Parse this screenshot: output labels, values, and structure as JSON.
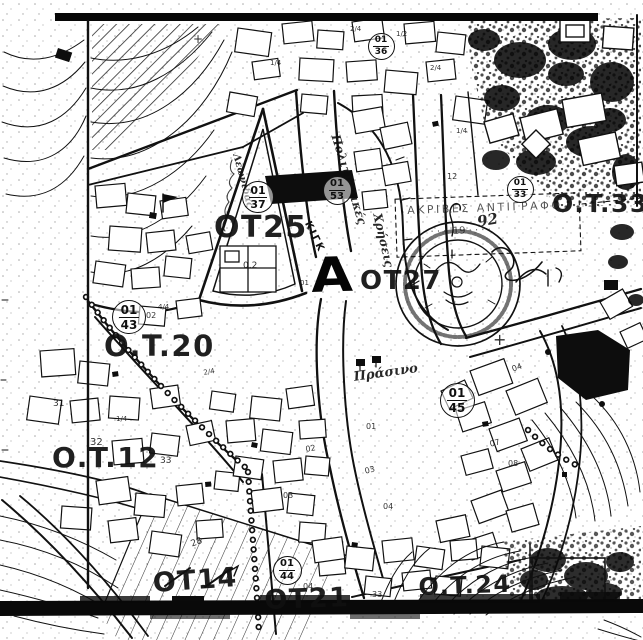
{
  "colors": {
    "ink": "#141414",
    "paper": "#ffffff"
  },
  "marker": {
    "text": "A"
  },
  "labels": {
    "blocks": [
      {
        "text": "OT25",
        "x": 214,
        "y": 213,
        "size": 30,
        "rot": 0
      },
      {
        "text": "O.T.33",
        "x": 552,
        "y": 191,
        "size": 25,
        "rot": 0
      },
      {
        "text": "OT27",
        "x": 360,
        "y": 268,
        "size": 26,
        "rot": 0
      },
      {
        "text": "O.T.20",
        "x": 104,
        "y": 332,
        "size": 29,
        "rot": 0
      },
      {
        "text": "O.T.12",
        "x": 52,
        "y": 444,
        "size": 28,
        "rot": 0
      },
      {
        "text": "OT14",
        "x": 152,
        "y": 570,
        "size": 27,
        "rot": -4
      },
      {
        "text": "OT21",
        "x": 264,
        "y": 587,
        "size": 27,
        "rot": -2
      },
      {
        "text": "O.T.24",
        "x": 418,
        "y": 575,
        "size": 24,
        "rot": -2
      }
    ],
    "circles": [
      {
        "top": "01",
        "bottom": "37",
        "cx": 257,
        "cy": 196,
        "d": 30
      },
      {
        "top": "01",
        "bottom": "53",
        "cx": 336,
        "cy": 189,
        "d": 27
      },
      {
        "top": "01",
        "bottom": "36",
        "cx": 380,
        "cy": 45,
        "d": 25
      },
      {
        "top": "01",
        "bottom": "33",
        "cx": 519,
        "cy": 188,
        "d": 25
      },
      {
        "top": "01",
        "bottom": "43",
        "cx": 128,
        "cy": 316,
        "d": 32
      },
      {
        "top": "01",
        "bottom": "44",
        "cx": 286,
        "cy": 569,
        "d": 27
      },
      {
        "top": "01",
        "bottom": "45",
        "cx": 456,
        "cy": 399,
        "d": 33
      }
    ],
    "notes": [
      {
        "text": "ΑΚΡΙΒΕΣ ΑΝΤΙΓΡΑΦΟ",
        "x": 407,
        "y": 205,
        "size": 11,
        "rot": -2,
        "ls": 2.5,
        "cls": "faded"
      },
      {
        "text": "· · · ·  19 · · · ·",
        "x": 424,
        "y": 228,
        "size": 10,
        "rot": -2,
        "cls": "faded"
      },
      {
        "text": "92",
        "x": 476,
        "y": 215,
        "size": 15,
        "rot": -10,
        "cls": "hand"
      },
      {
        "text": "Πολιτιστικές",
        "x": 341,
        "y": 133,
        "size": 12,
        "rot": 73,
        "cls": "hand"
      },
      {
        "text": "Χρήσεις",
        "x": 383,
        "y": 212,
        "size": 12,
        "rot": 77,
        "cls": "hand"
      },
      {
        "text": "ΚΙΓΚ",
        "x": 311,
        "y": 220,
        "size": 10,
        "rot": 64,
        "ls": 2
      },
      {
        "text": "Πράσινο",
        "x": 353,
        "y": 371,
        "size": 13,
        "rot": -8,
        "cls": "hand"
      },
      {
        "text": "Λεωνίδας",
        "x": 240,
        "y": 153,
        "size": 10,
        "rot": 75,
        "cls": "hand"
      }
    ],
    "tiny": [
      {
        "text": "0.2",
        "x": 243,
        "y": 262,
        "size": 9
      },
      {
        "text": "02",
        "x": 146,
        "y": 312,
        "size": 8
      },
      {
        "text": "32",
        "x": 90,
        "y": 438,
        "size": 10
      },
      {
        "text": "33",
        "x": 160,
        "y": 457,
        "size": 9
      },
      {
        "text": "31",
        "x": 53,
        "y": 400,
        "size": 9
      },
      {
        "text": "02",
        "x": 305,
        "y": 446,
        "size": 8,
        "rot": -10
      },
      {
        "text": "03",
        "x": 283,
        "y": 492,
        "size": 8
      },
      {
        "text": "03",
        "x": 364,
        "y": 468,
        "size": 8,
        "rot": -15
      },
      {
        "text": "04",
        "x": 383,
        "y": 503,
        "size": 8
      },
      {
        "text": "01",
        "x": 366,
        "y": 423,
        "size": 8
      },
      {
        "text": "28",
        "x": 190,
        "y": 541,
        "size": 9,
        "rot": -20
      },
      {
        "text": "04",
        "x": 303,
        "y": 583,
        "size": 8
      },
      {
        "text": "04",
        "x": 511,
        "y": 366,
        "size": 8,
        "rot": -20
      },
      {
        "text": "07",
        "x": 489,
        "y": 441,
        "size": 8,
        "rot": -15
      },
      {
        "text": "08",
        "x": 508,
        "y": 460,
        "size": 8
      },
      {
        "text": "12",
        "x": 447,
        "y": 173,
        "size": 8
      },
      {
        "text": "1/4",
        "x": 456,
        "y": 128,
        "size": 7
      },
      {
        "text": "2/4",
        "x": 350,
        "y": 26,
        "size": 7
      },
      {
        "text": "1/2",
        "x": 396,
        "y": 31,
        "size": 7
      },
      {
        "text": "1/4",
        "x": 116,
        "y": 416,
        "size": 7
      },
      {
        "text": "4/4",
        "x": 158,
        "y": 304,
        "size": 7
      },
      {
        "text": "2/4",
        "x": 203,
        "y": 370,
        "size": 7,
        "rot": -10
      },
      {
        "text": "1/4",
        "x": 270,
        "y": 60,
        "size": 7
      },
      {
        "text": "2/4",
        "x": 430,
        "y": 65,
        "size": 7
      },
      {
        "text": "01",
        "x": 300,
        "y": 280,
        "size": 7
      },
      {
        "text": "33",
        "x": 372,
        "y": 591,
        "size": 8
      },
      {
        "text": "+",
        "x": 493,
        "y": 332,
        "size": 16
      },
      {
        "text": "+",
        "x": 193,
        "y": 33,
        "size": 12
      }
    ]
  }
}
